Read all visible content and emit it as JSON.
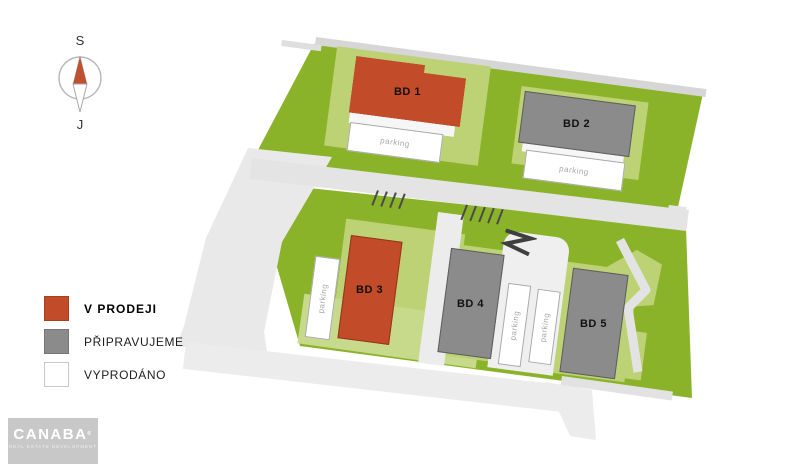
{
  "compass": {
    "north_label": "S",
    "south_label": "J"
  },
  "legend": {
    "items": [
      {
        "label": "V PRODEJI",
        "color": "#c24b29",
        "status": "for-sale"
      },
      {
        "label": "PŘIPRAVUJEME",
        "color": "#8b8b8b",
        "status": "in-preparation"
      },
      {
        "label": "VYPRODÁNO",
        "color": "#ffffff",
        "status": "sold-out"
      }
    ]
  },
  "plan": {
    "buildings": [
      {
        "label": "BD 1",
        "status": "for-sale"
      },
      {
        "label": "BD 2",
        "status": "in-preparation"
      },
      {
        "label": "BD 3",
        "status": "for-sale"
      },
      {
        "label": "BD 4",
        "status": "in-preparation"
      },
      {
        "label": "BD 5",
        "status": "in-preparation"
      }
    ],
    "parking_label": "parking"
  },
  "logo": {
    "name": "CANABA",
    "mark": "®",
    "tagline": "REAL ESTATE DEVELOPMENT"
  },
  "colors": {
    "for_sale": "#c24b29",
    "in_preparation": "#8b8b8b",
    "sold_out": "#ffffff",
    "grass": "#8bb32a",
    "grass_light": "#bdd275",
    "road": "#e9e9e9"
  }
}
